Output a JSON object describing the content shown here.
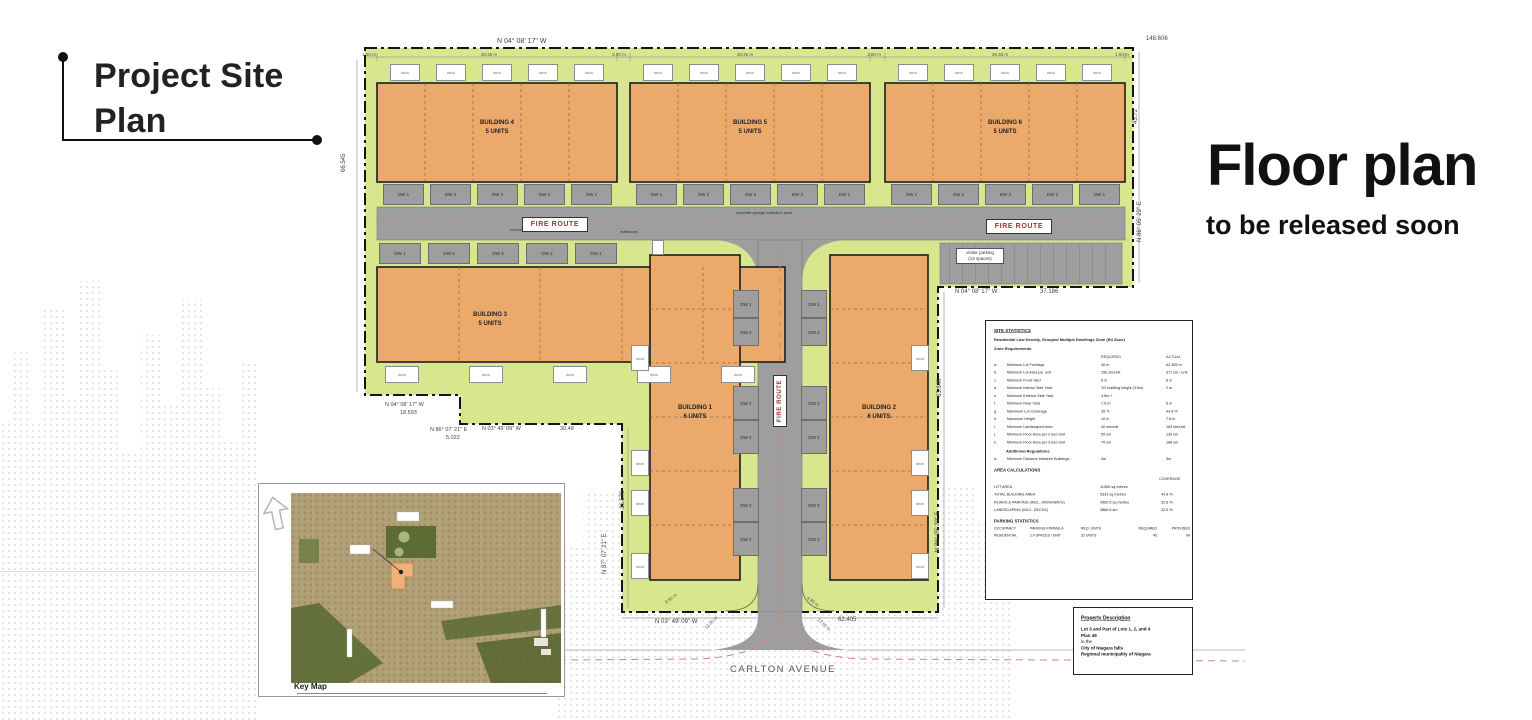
{
  "header": {
    "title": "Project Site Plan"
  },
  "promo": {
    "title": "Floor plan",
    "subtitle": "to be released soon"
  },
  "site_plan": {
    "street_name": "CARLTON AVENUE",
    "fire_route": "FIRE ROUTE",
    "chips": {
      "deck": "deck",
      "dw1": "DW 1",
      "dw2": "DW 2",
      "dw3": "DW 3"
    },
    "visitor_parking_line1": "visitor parking",
    "visitor_parking_line2": "(12 spaces)",
    "mailboxes_note": "mailboxes",
    "curb_note": "concrete curb (typ)",
    "garage_note": "concrete garage collection pads",
    "buildings": [
      {
        "name": "BUILDING 1",
        "units": "6 UNITS"
      },
      {
        "name": "BUILDING 2",
        "units": "6 UNITS"
      },
      {
        "name": "BUILDING 3",
        "units": "5 UNITS"
      },
      {
        "name": "BUILDING 4",
        "units": "5 UNITS"
      },
      {
        "name": "BUILDING 5",
        "units": "5 UNITS"
      },
      {
        "name": "BUILDING 6",
        "units": "5 UNITS"
      }
    ],
    "dimensions": {
      "top_bearing": "N 04° 08' 17\" W",
      "top_length": "148.606",
      "top_ticks": [
        "1.50 m",
        "46.35 m",
        "3.00 m",
        "46.35 m",
        "3.00 m",
        "46.35 m",
        "1.50 m"
      ],
      "west_length": "66.545",
      "east_length_upper": "45.72",
      "east_bearing_upper": "N 86° 05' 29\" E",
      "south_bearing_east_section": "N 04° 08' 17\" W",
      "south_length_east_section": "37.186",
      "mid_east_length": "63.848",
      "mid_east_bearing": "N 86° 05' 29\" E",
      "mid_west_length": "36.576",
      "mid_west_bearing": "N 87° 07' 21\" E",
      "jog_bearing_1": "N 04° 08' 17\" W",
      "jog_length_1": "18.593",
      "jog_bearing_2": "N 86° 07' 21\" E",
      "jog_length_2": "5.022",
      "jog_bearing_3": "N 03° 49' 09\" W",
      "jog_length_3": "30.48",
      "south_bearing": "N 03° 49' 09\" W",
      "south_length": "62.405",
      "flare_left": "8.55 m",
      "flare_right": "4.85 m",
      "radius_left": "12.50 m",
      "radius_right": "12.50 m"
    }
  },
  "key_map": {
    "label": "Key Map"
  },
  "stats": {
    "title": "SITE STATISTICS",
    "zone": "Residential Low Density, Grouped Multiple Dwellings Zone (R4 Zone)",
    "section1": "Zone Requirements",
    "col_required": "REQUIRED",
    "col_actual": "ACTUAL",
    "rows": [
      {
        "l": "a.",
        "d": "Minimum Lot Frontage",
        "r": "30 m",
        "a": "62.405 m"
      },
      {
        "l": "b.",
        "d": "Minimum Lot Area per unit",
        "r": "250 sm/unit",
        "a": "371 sm / unit"
      },
      {
        "l": "c.",
        "d": "Minimum Front Yard",
        "r": "6 m",
        "a": "6 m"
      },
      {
        "l": "d.",
        "d": "Minimum Interior Side Yard",
        "r": "1/2 building height (3.5m)",
        "a": "2 m"
      },
      {
        "l": "e.",
        "d": "Minimum Exterior Side Yard",
        "r": "4.5m +",
        "a": ""
      },
      {
        "l": "f.",
        "d": "Minimum Rear Yard",
        "r": "7.5 m",
        "a": "6 m"
      },
      {
        "l": "g.",
        "d": "Maximum Lot Coverage",
        "r": "35 %",
        "a": "44.8 %"
      },
      {
        "l": "h.",
        "d": "Maximum Height",
        "r": "10 m",
        "a": "7.8 m"
      },
      {
        "l": "i.",
        "d": "Minimum Landscaped Area",
        "r": "40 sm/unit",
        "a": "163 sm/unit"
      },
      {
        "l": "j.",
        "d": "Minimum Floor Area per 2 bed Unit",
        "r": "55 sm",
        "a": "139 sm"
      },
      {
        "l": "k.",
        "d": "Minimum Floor Area per 3 bed Unit",
        "r": "75 sm",
        "a": "188 sm"
      }
    ],
    "additional": "Additional Regulations",
    "additional_rows": [
      {
        "l": "a.",
        "d": "Minimum Distance between Buildings",
        "r": "3m",
        "a": "3m"
      }
    ],
    "area_title": "AREA CALCULATIONS",
    "col_coverage": "COVERAGE",
    "area_rows": [
      {
        "d": "LOT AREA",
        "v": "11900 sq metres",
        "c": ""
      },
      {
        "d": "TOTAL BUILDING AREA",
        "v": "5333 sq metres",
        "c": "44.8 %"
      },
      {
        "d": "ROADS & PARKING (INCL. DRIVEWAYS)",
        "v": "3900.5 sq metres",
        "c": "32.8 %"
      },
      {
        "d": "LANDSCAPING (INCL. DECKS)",
        "v": "3866.5 sm",
        "c": "32.5 %"
      }
    ],
    "parking_title": "PARKING STATISTICS",
    "parking_cols": [
      "OCCUPANCY",
      "PARKING FORMULA",
      "REQ. UNITS",
      "REQUIRED",
      "PROVIDED"
    ],
    "parking_row": [
      "RESIDENTIAL",
      "1.4 SPACES / UNIT",
      "32 UNITS",
      "45",
      "64"
    ]
  },
  "property": {
    "title": "Property Description",
    "line1": "Lot 3 and Part of Lots 1, 2, and 4",
    "line2": "Plan 49",
    "line3": "in the",
    "line4": "City of Niagara falls",
    "line5": "Regional municipality of Niagara"
  },
  "colors": {
    "landscape_green": "#d8e68e",
    "building_orange": "#ebaa6c",
    "road_gray": "#9e9e9e",
    "centerline_red": "#cf8578"
  }
}
